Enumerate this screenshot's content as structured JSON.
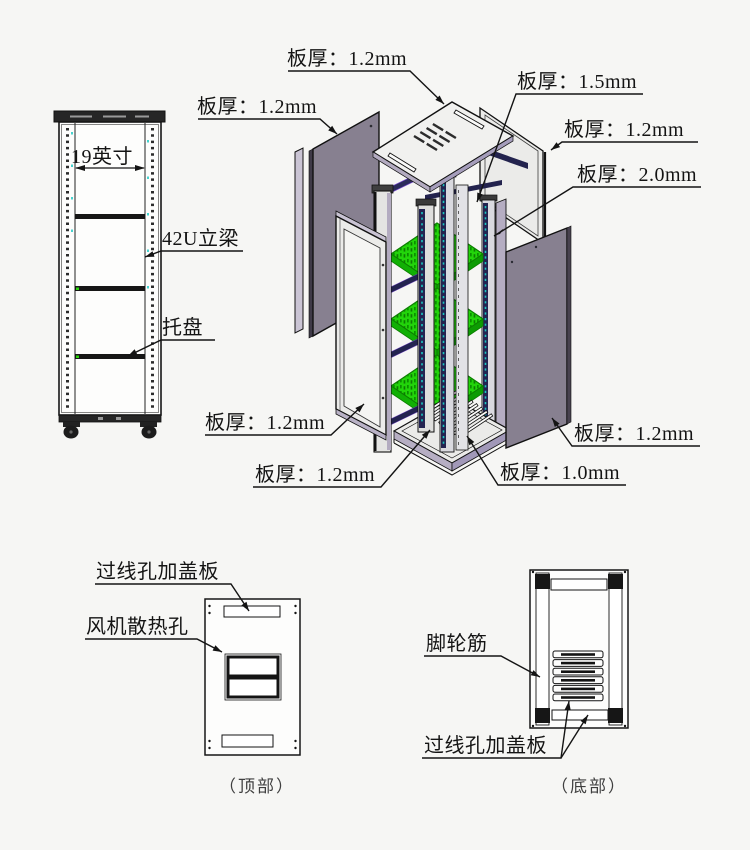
{
  "thickness": {
    "top_cover": "板厚：1.2mm",
    "left_side_panel": "板厚：1.2mm",
    "frame": "板厚：1.5mm",
    "back_panel": "板厚：1.2mm",
    "vertical_beam": "板厚：2.0mm",
    "front_door": "板厚：1.2mm",
    "base_frame": "板厚：1.2mm",
    "right_side_panel": "板厚：1.2mm",
    "bottom_cover": "板厚：1.0mm"
  },
  "front_view": {
    "width_label": "19英寸",
    "beam_label": "42U立梁",
    "tray_label": "托盘"
  },
  "top_view": {
    "cable_cover_label": "过线孔加盖板",
    "fan_vent_label": "风机散热孔",
    "caption": "（顶部）"
  },
  "bottom_view": {
    "caster_rib_label": "脚轮筋",
    "cable_cover_label": "过线孔加盖板",
    "caption": "（底部）"
  },
  "colors": {
    "background": "#f6f6f4",
    "line": "#141414",
    "dark_panel": "#878090",
    "light_panel": "#ebebe9",
    "panel_face": "#f1f1ef",
    "shelf_green": "#22d40a",
    "shelf_green_dark": "#0a8f00",
    "rail_navy": "#232350",
    "rail_teal": "#19c8c2",
    "edge_lavender": "#b3abc0",
    "caption_gray": "#3f3f3f"
  }
}
